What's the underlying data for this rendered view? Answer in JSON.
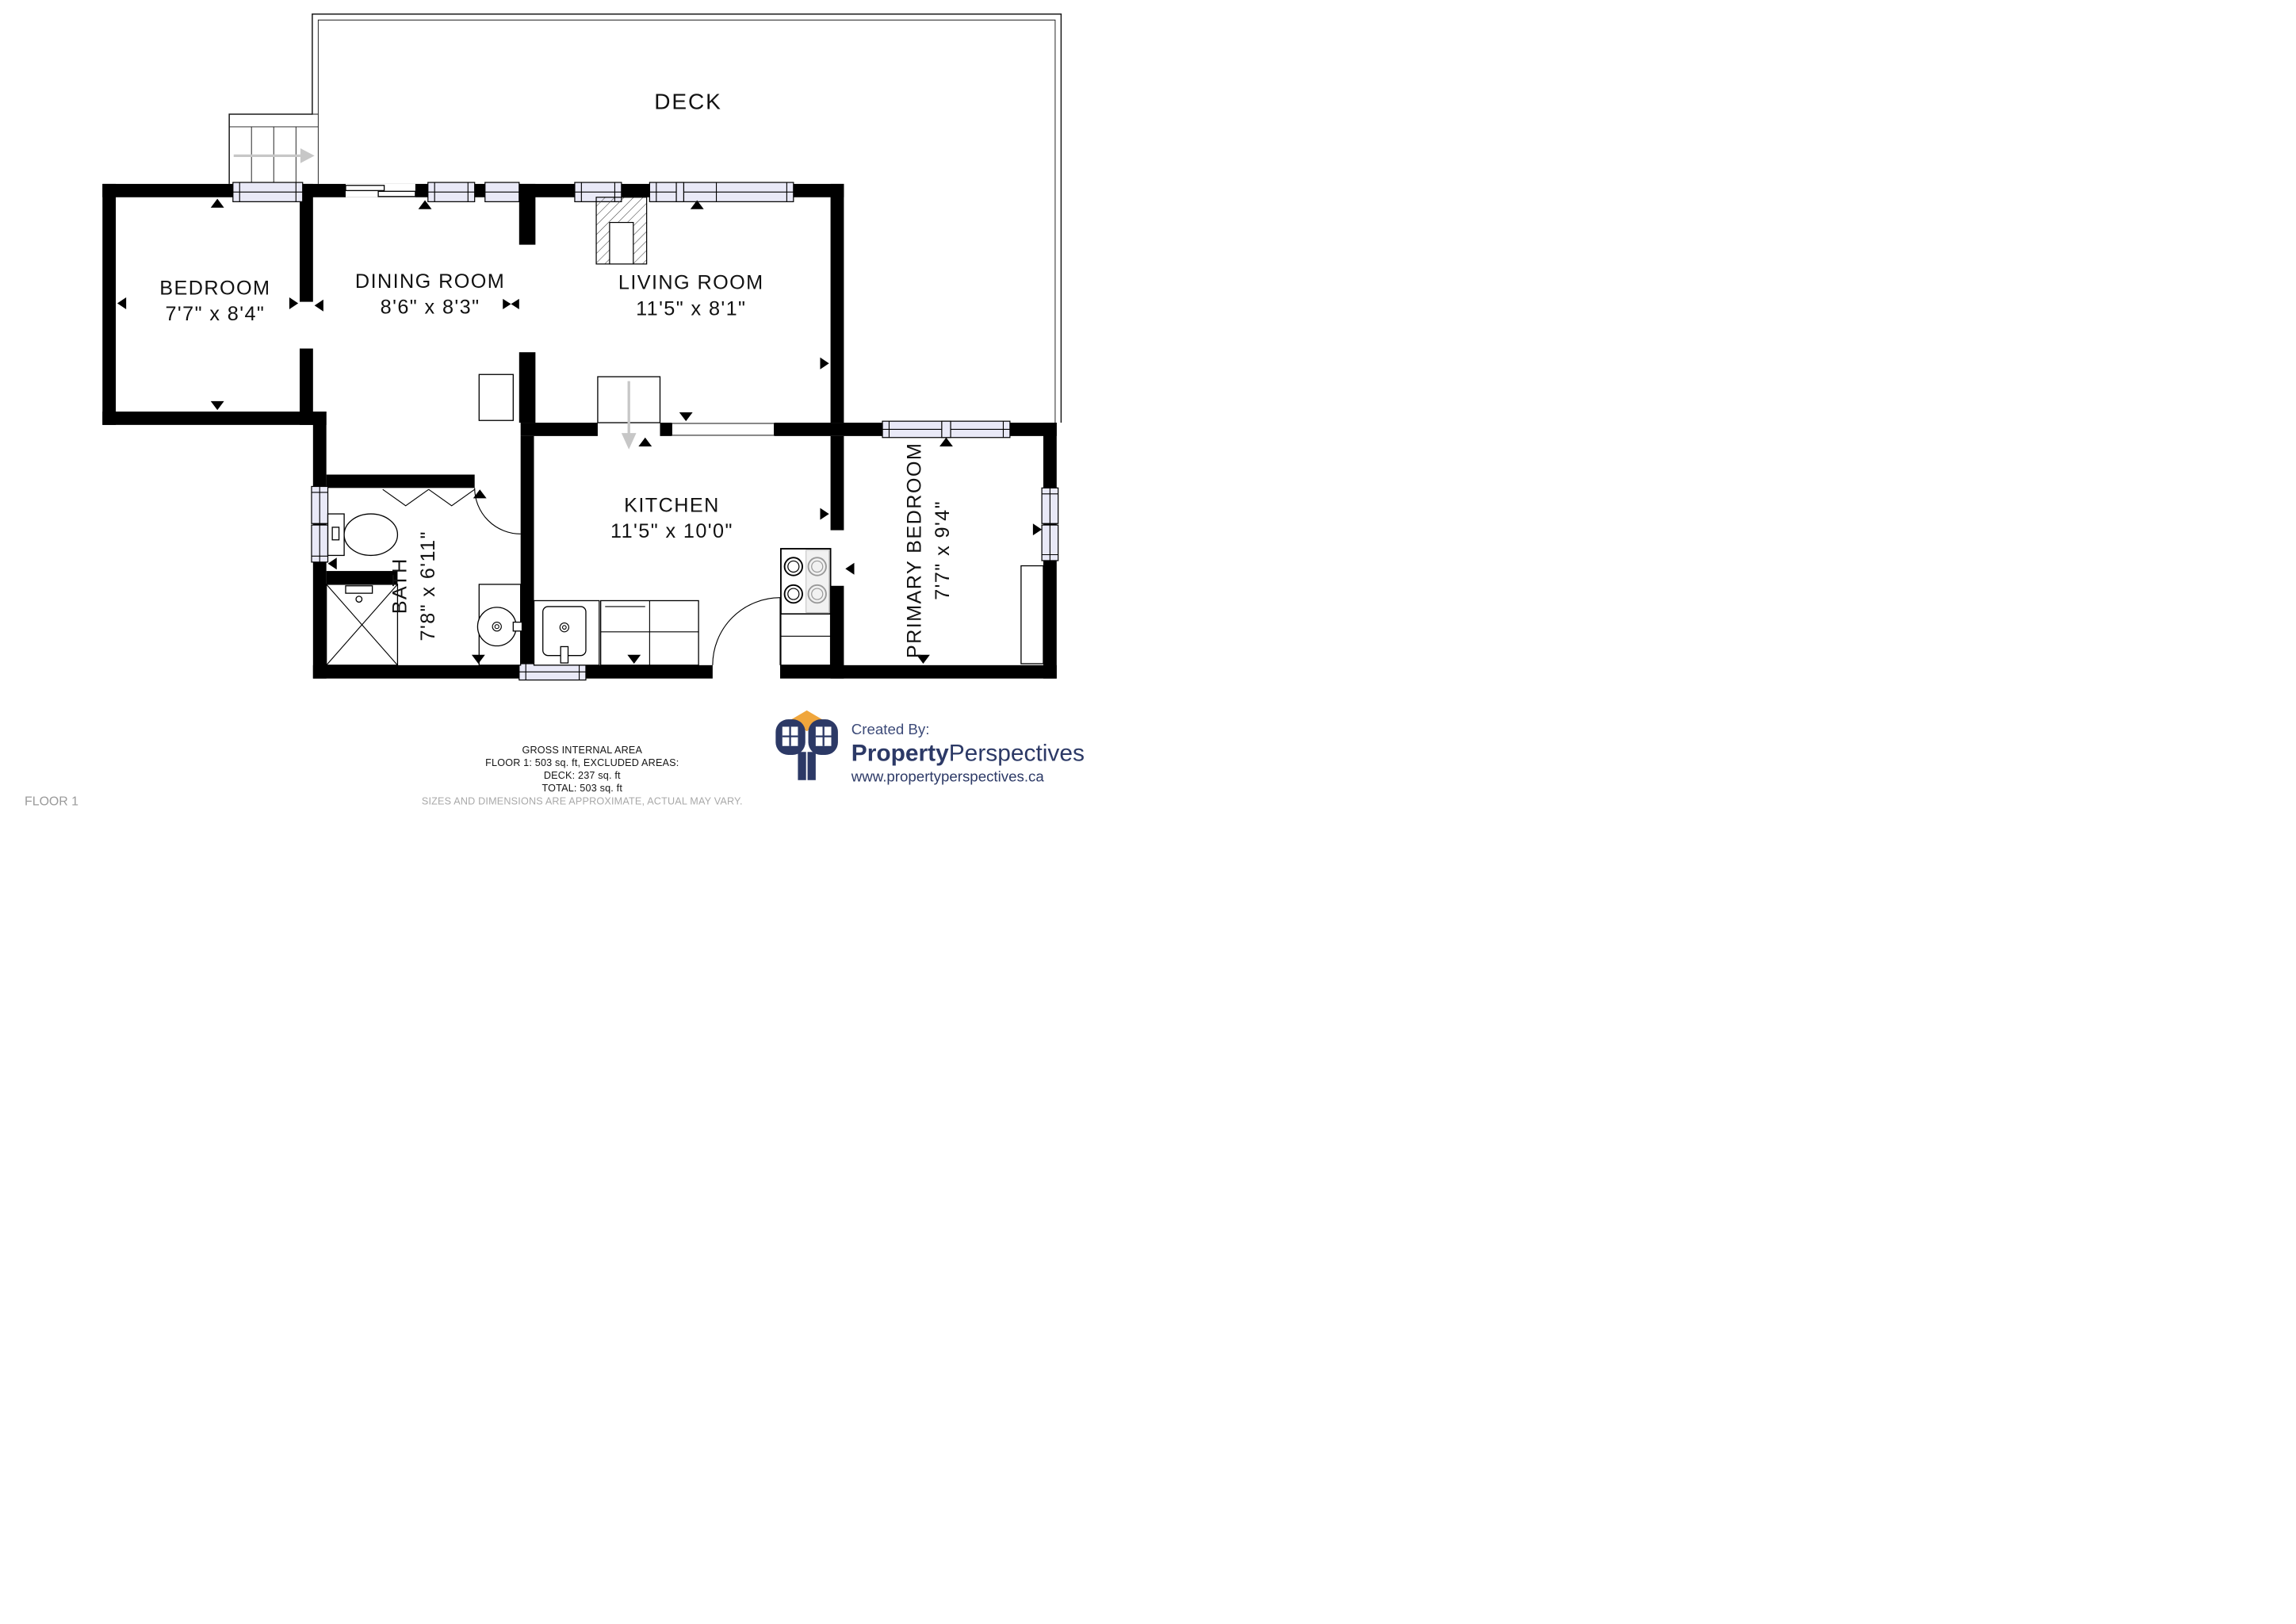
{
  "floor_plan": {
    "rooms": [
      {
        "id": "deck",
        "label": "DECK",
        "dimensions": ""
      },
      {
        "id": "bedroom",
        "label": "BEDROOM",
        "dimensions": "7'7\" x 8'4\""
      },
      {
        "id": "dining_room",
        "label": "DINING ROOM",
        "dimensions": "8'6\" x 8'3\""
      },
      {
        "id": "living_room",
        "label": "LIVING ROOM",
        "dimensions": "11'5\" x 8'1\""
      },
      {
        "id": "bath",
        "label": "BATH",
        "dimensions": "7'8\" x 6'11\""
      },
      {
        "id": "kitchen",
        "label": "KITCHEN",
        "dimensions": "11'5\" x 10'0\""
      },
      {
        "id": "primary_bedroom",
        "label": "PRIMARY BEDROOM",
        "dimensions": "7'7\" x 9'4\""
      }
    ],
    "floor_label": "FLOOR 1"
  },
  "footer": {
    "area_summary": {
      "title": "GROSS INTERNAL AREA",
      "floor_line": "FLOOR 1: 503 sq. ft, EXCLUDED AREAS:",
      "deck_line": "DECK: 237 sq. ft",
      "total_line": "TOTAL: 503 sq. ft",
      "disclaimer": "SIZES AND DIMENSIONS ARE APPROXIMATE, ACTUAL MAY VARY."
    },
    "branding": {
      "created_by": "Created By:",
      "brand_bold": "Property",
      "brand_regular": "Perspectives",
      "website": "www.propertyperspectives.ca",
      "navy": "#2c3966",
      "orange": "#f0a63c"
    }
  }
}
